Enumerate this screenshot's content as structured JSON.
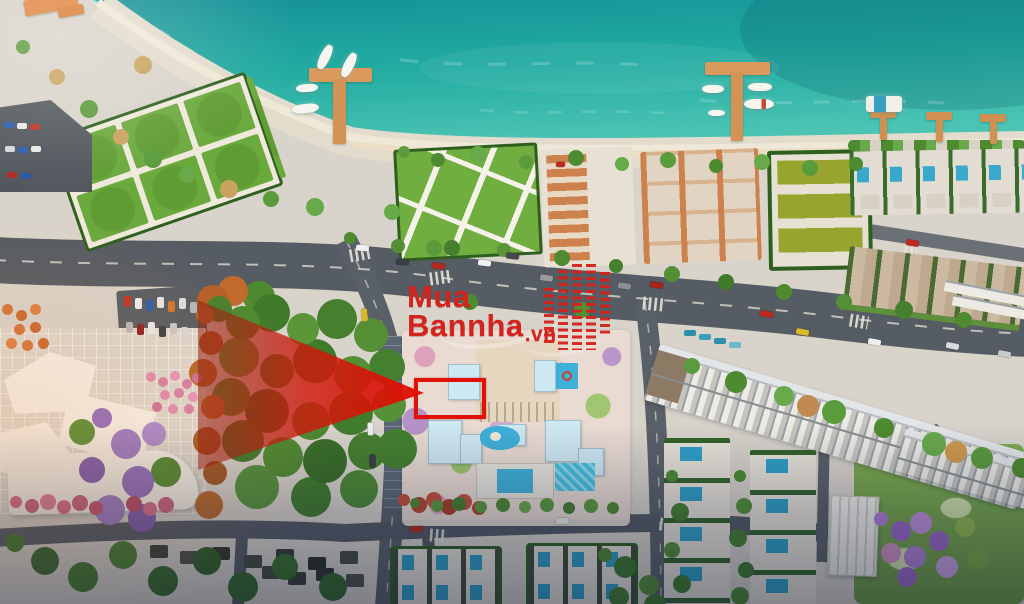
{
  "watermark": {
    "line1": "Mua",
    "line2": "Bannha",
    "suffix": ".vn",
    "text_color": "#d3231c"
  },
  "annotations": {
    "pointer_arrow_color": "#e0150a",
    "highlight_box_color": "#e01208"
  },
  "palette": {
    "sea": "#1fa8a0",
    "sea-deep": "#0f8489",
    "shore-foam": "#9fe0d2",
    "sand": "#ece5d6",
    "asphalt": "#565c64",
    "sidewalk": "#d9d4ca",
    "lawn": "#6aa93c",
    "hedge": "#2e5f1e",
    "terracotta": "#cd824d",
    "pool": "#3fb0d8",
    "building-white": "#f2efe9",
    "roof-blue": "#cfe9f2",
    "tree-green": "#4e8a30",
    "tree-autumn": "#b5662a",
    "tree-purple": "#9b7bc8",
    "tree-pink": "#d66a8a",
    "pier-wood": "#d99a5c",
    "wmred": "#d3231c",
    "highlight": "#e01208"
  }
}
